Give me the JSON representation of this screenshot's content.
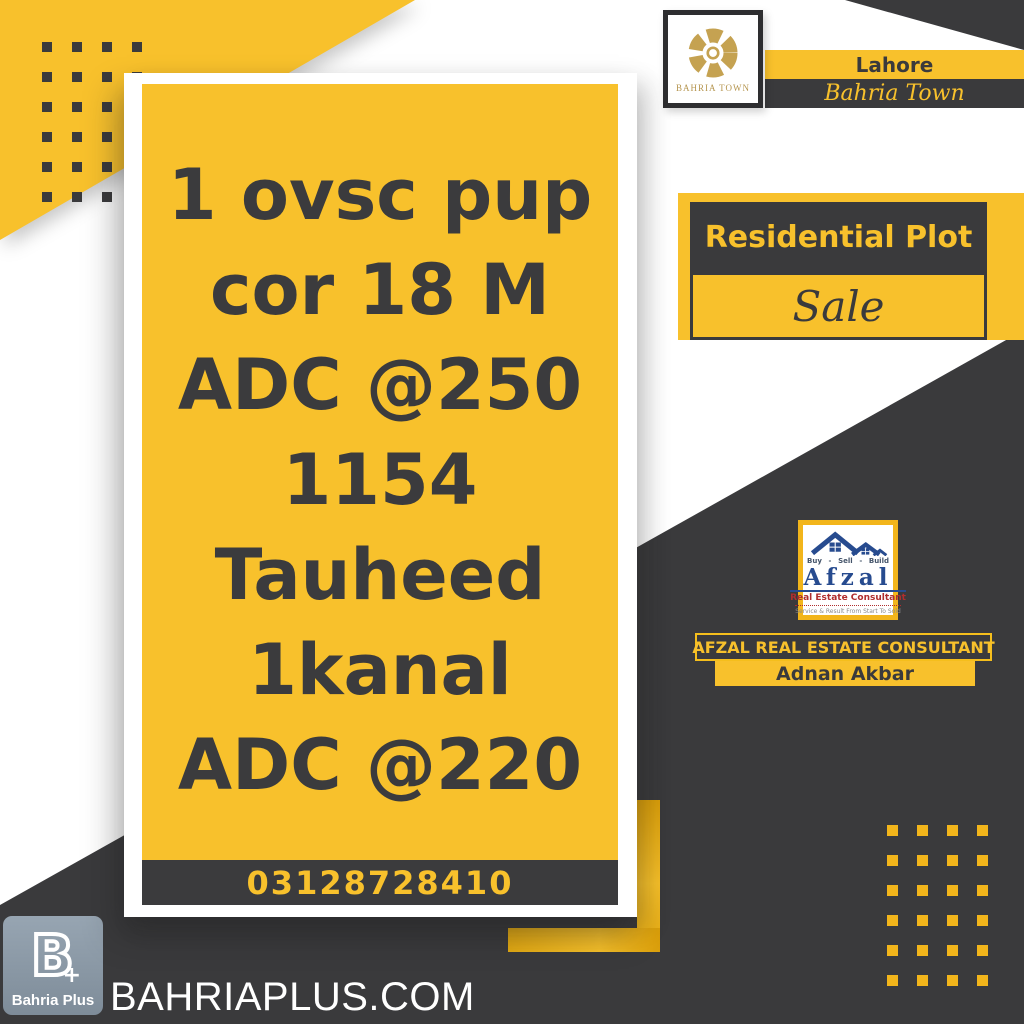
{
  "poster": {
    "bahria_town": {
      "logo_text": "BAHRIA TOWN",
      "city": "Lahore",
      "name": "Bahria Town"
    },
    "badge": {
      "category": "Residential Plot",
      "status": "Sale"
    },
    "listing": {
      "lines": [
        "1 ovsc pup",
        "cor 18 M",
        "ADC @250",
        "1154",
        "Tauheed",
        "1kanal",
        "ADC @220"
      ],
      "phone": "03128728410"
    },
    "afzal": {
      "buy": "Buy",
      "dash1": "-",
      "sell": "Sell",
      "dash2": "-",
      "build": "Build",
      "name": "Afzal",
      "subtitle": "Real Estate Consultant",
      "motto": "Service & Result From Start To Sold",
      "company": "AFZAL REAL ESTATE CONSULTANT",
      "agent": "Adnan Akbar"
    },
    "bahria_plus": {
      "monogram": "B",
      "plus": "+",
      "label": "Bahria Plus",
      "website": "BAHRIAPLUS.COM"
    },
    "colors": {
      "yellow": "#F8C12C",
      "dark": "#3A3A3C",
      "gold": "#C5A251",
      "navy": "#274B8F",
      "red": "#B02E2E",
      "steel": "#8E9BA9"
    }
  }
}
